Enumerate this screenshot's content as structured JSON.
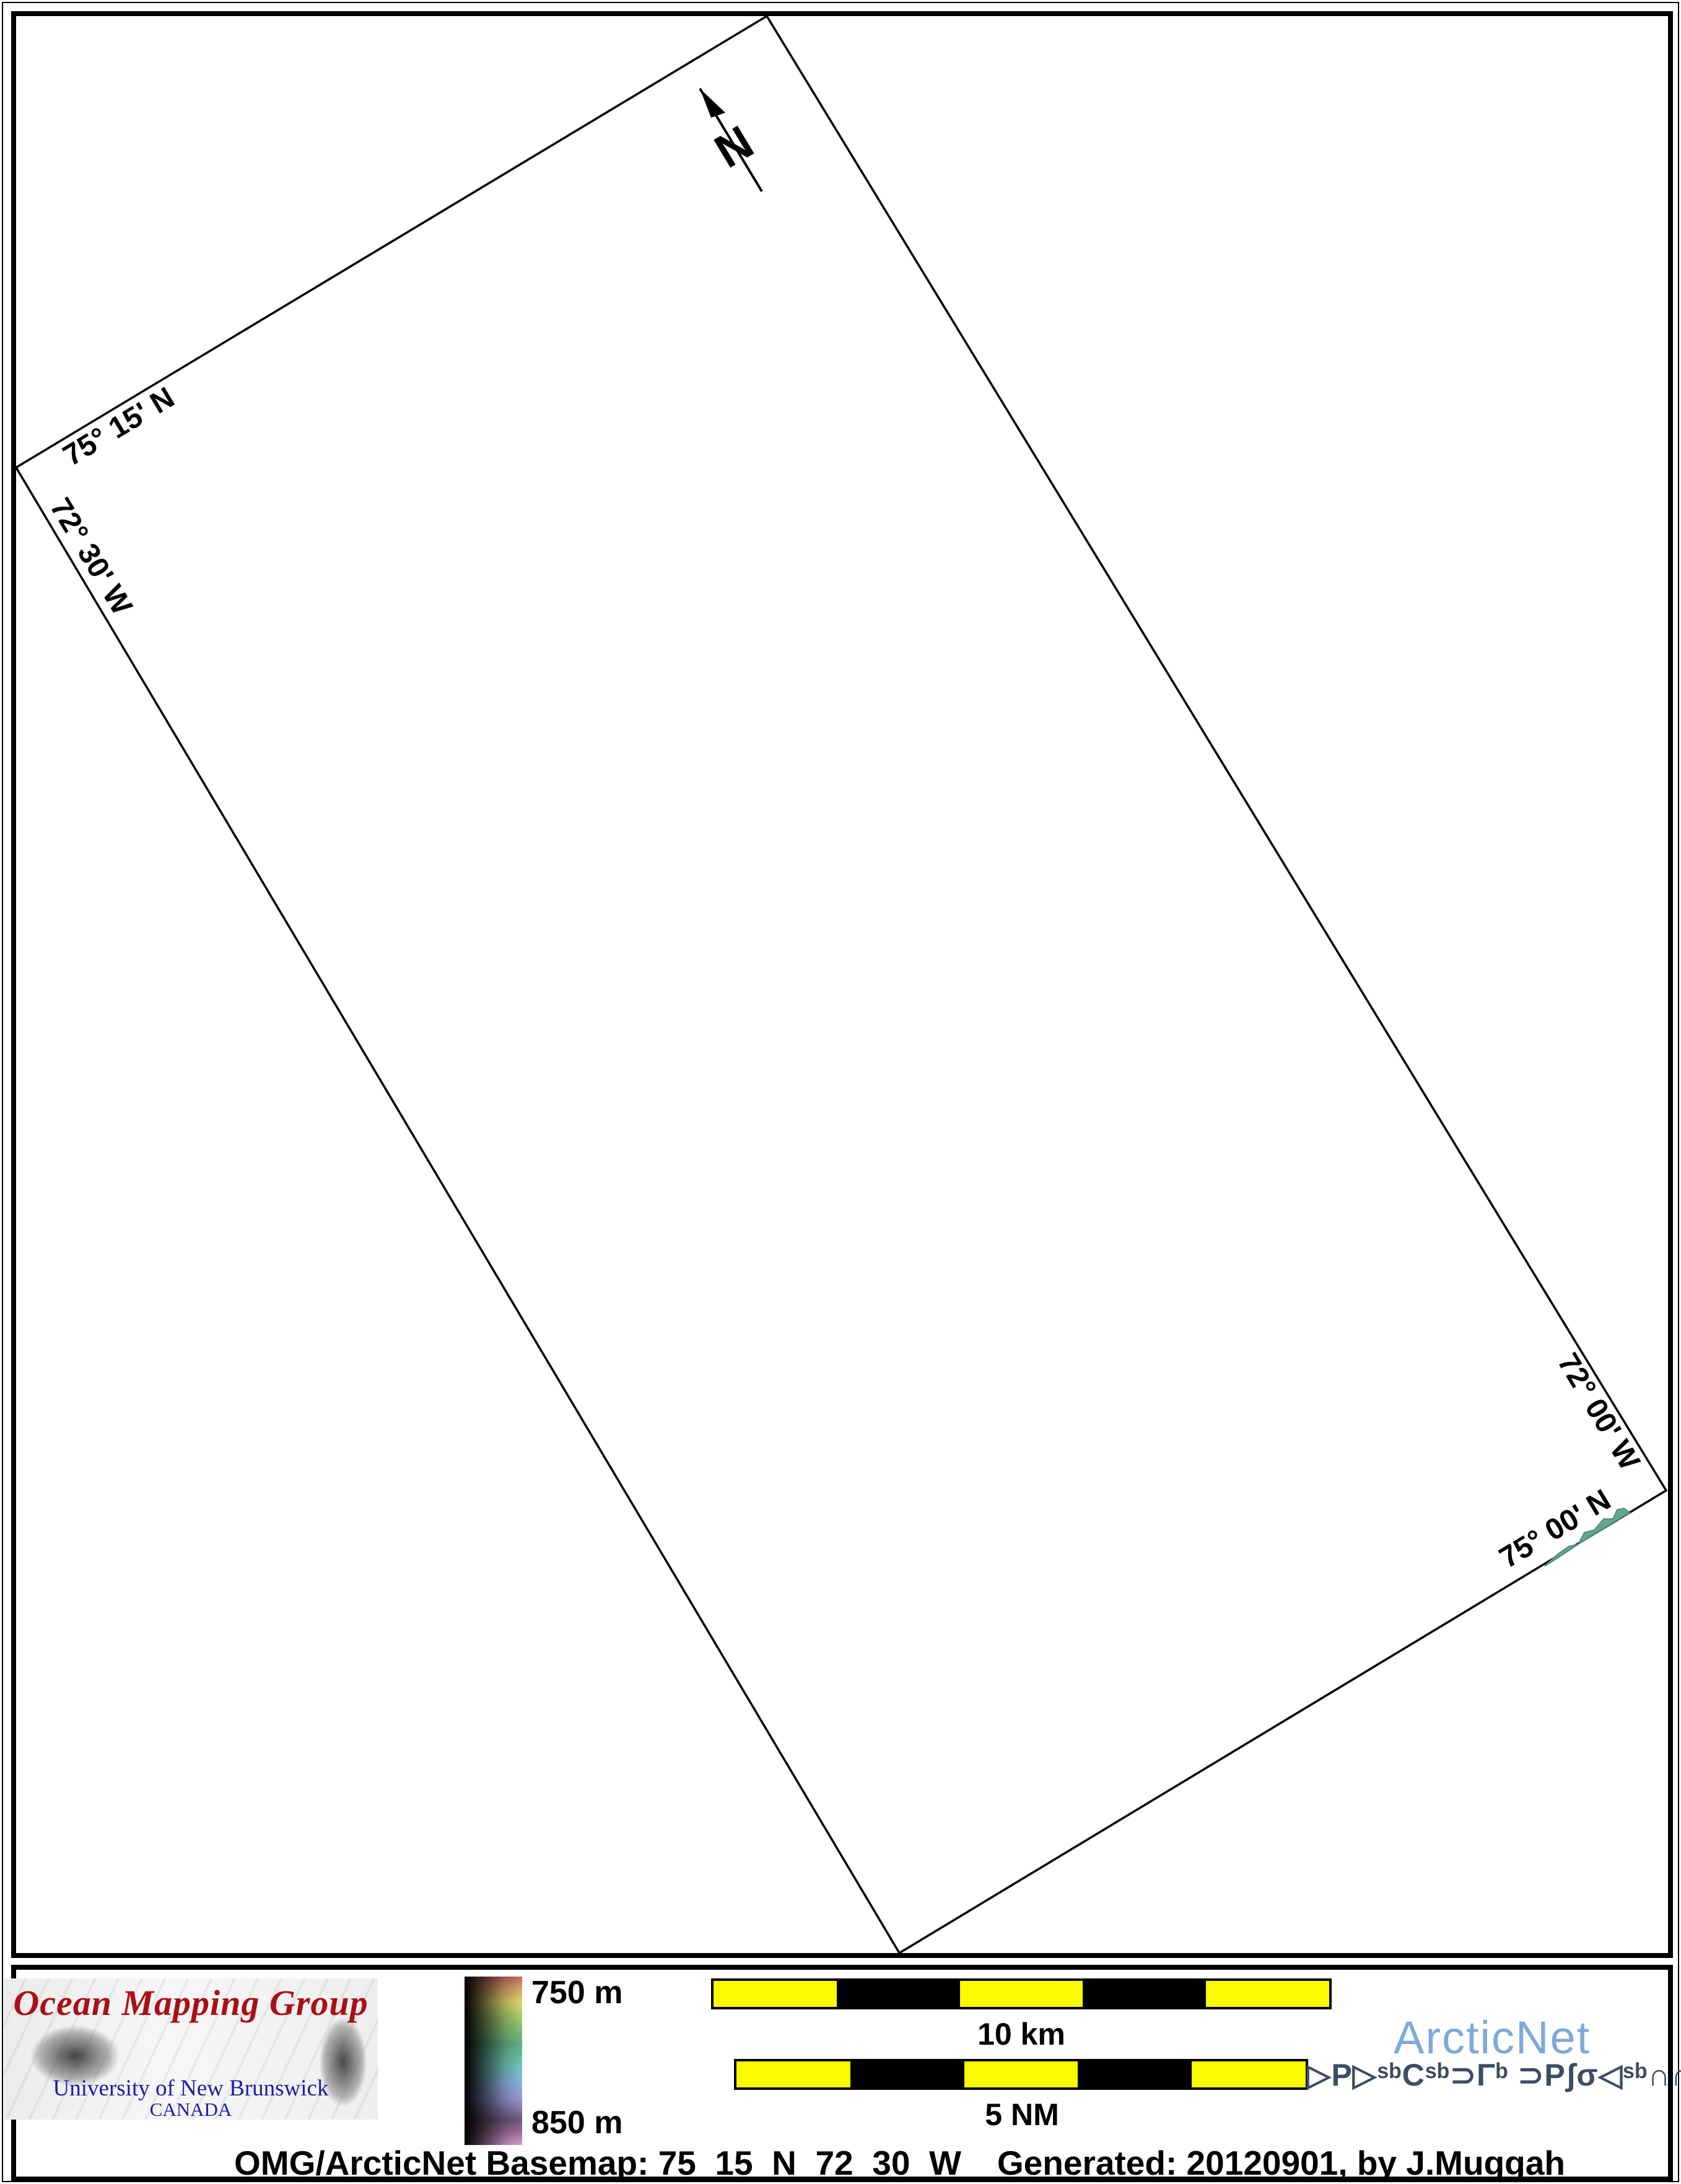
{
  "map": {
    "north_label": "N",
    "labels": {
      "top_lat": "75° 15' N",
      "left_lon": "72° 30' W",
      "right_lon": "72° 00' W",
      "bottom_lat": "75° 00' N"
    },
    "land_patch_color": "#63a78f"
  },
  "legend": {
    "omg_logo": {
      "title": "Ocean Mapping Group",
      "subtitle": "University of New Brunswick",
      "country": "CANADA",
      "title_color": "#a91016",
      "subtitle_color": "#1c1ca8"
    },
    "colorbar": {
      "top_label": "750 m",
      "bottom_label": "850 m"
    },
    "scalebar_km": {
      "label": "10 km",
      "segments": 5,
      "bar_color": "#fbfb00"
    },
    "scalebar_nm": {
      "label": "5 NM",
      "segments": 5,
      "bar_color": "#fbfb00"
    },
    "arcticnet": {
      "wordmark": "ArcticNet",
      "wordmark_color": "#7fa9d9",
      "inuktitut": "ᐅᑭᐅᖅᑕᖅᑐᒥᒃ ᑐᑭᓯᓂᐊᖅᑎᒌᑦ",
      "inuktitut_display": "▷P▷ˢᵇCˢᵇ⊃Γᵇ ⊃Pʃσ◁ˢᵇ∩∩̇ᶜ",
      "inuktitut_color": "#3d4d63"
    }
  },
  "caption": {
    "basemap": "OMG/ArcticNet Basemap: 75_15_N_72_30_W",
    "generated": "Generated: 20120901, by J.Muggah"
  }
}
